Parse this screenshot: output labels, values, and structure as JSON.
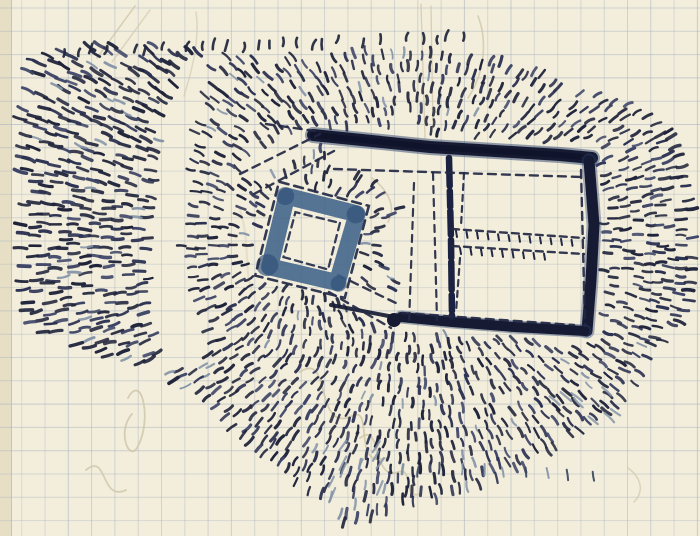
{
  "artwork": {
    "kind": "hand-drawn earthwork plan, ink and blue wash on graph paper",
    "paper": {
      "background": "#f3eedb",
      "left_edge_band": "#e7dfc5",
      "left_edge_line": "#cdc3a4",
      "left_edge_width": 11
    },
    "grid": {
      "color": "#a9b3c0",
      "spacing": 23.3,
      "offset_x": 21.7,
      "offset_y": 8.0,
      "base_opacity": 0.34,
      "opacity_jitter": 0.26
    },
    "inks": {
      "dark": "#20243b",
      "mid": "#2c3252",
      "light": "#3d4466",
      "rampart": "#161b33",
      "rampart_core": "#10142a",
      "rampart_wash": "#2e4470",
      "wash_blue": "#44658b",
      "wash_blue_dark": "#2f4f76",
      "gray_blue": "#8494a8",
      "pencil": "#cfc7ab"
    },
    "hachure_field": {
      "seed": 7,
      "center_main": [
        415,
        245
      ],
      "center_square": [
        312,
        240
      ],
      "square_influence": [
        95,
        135
      ],
      "ring_step": 10.6,
      "arc_step": 10.2,
      "skip_probability": 0.13,
      "radius_range": [
        40,
        452
      ],
      "include_polygon": [
        [
          26,
          62
        ],
        [
          78,
          46
        ],
        [
          148,
          42
        ],
        [
          210,
          48
        ],
        [
          258,
          60
        ],
        [
          330,
          52
        ],
        [
          420,
          46
        ],
        [
          505,
          62
        ],
        [
          575,
          82
        ],
        [
          625,
          102
        ],
        [
          668,
          128
        ],
        [
          694,
          168
        ],
        [
          698,
          240
        ],
        [
          694,
          302
        ],
        [
          662,
          350
        ],
        [
          620,
          404
        ],
        [
          566,
          450
        ],
        [
          514,
          472
        ],
        [
          446,
          496
        ],
        [
          382,
          514
        ],
        [
          344,
          524
        ],
        [
          160,
          370
        ],
        [
          84,
          350
        ],
        [
          30,
          334
        ],
        [
          14,
          262
        ],
        [
          15,
          150
        ]
      ],
      "exclusions": {
        "valley": [
          [
            186,
            52
          ],
          [
            214,
            52
          ],
          [
            196,
            120
          ],
          [
            180,
            250
          ],
          [
            208,
            332
          ],
          [
            199,
            370
          ],
          [
            160,
            370
          ],
          [
            146,
            255
          ],
          [
            162,
            120
          ]
        ],
        "large_enclosure": [
          [
            312,
            124
          ],
          [
            600,
            145
          ],
          [
            603,
            345
          ],
          [
            391,
            329
          ],
          [
            411,
            199
          ],
          [
            331,
            163
          ]
        ],
        "small_enclosure": [
          [
            274,
            177
          ],
          [
            375,
            202
          ],
          [
            350,
            303
          ],
          [
            249,
            278
          ]
        ],
        "upper_causeway": [
          [
            235,
            161
          ],
          [
            313,
            125
          ],
          [
            331,
            141
          ],
          [
            251,
            183
          ]
        ],
        "lower_causeway": [
          [
            333,
            271
          ],
          [
            401,
            303
          ],
          [
            393,
            331
          ],
          [
            323,
            293
          ]
        ]
      }
    },
    "large_enclosure": {
      "top_bar": [
        [
          313,
          135
        ],
        [
          430,
          147
        ],
        [
          560,
          155
        ],
        [
          592,
          158
        ]
      ],
      "right_bar": [
        [
          589,
          161
        ],
        [
          594,
          225
        ],
        [
          591,
          280
        ],
        [
          587,
          331
        ]
      ],
      "bottom_bar": [
        [
          585,
          331
        ],
        [
          515,
          327
        ],
        [
          452,
          322
        ],
        [
          401,
          317
        ]
      ],
      "corner_blob": [
        394,
        320,
        7
      ],
      "tail": [
        [
          399,
          318
        ],
        [
          331,
          305
        ]
      ],
      "inner_wall": [
        [
          449,
          158
        ],
        [
          451,
          240
        ],
        [
          452,
          317
        ]
      ],
      "dashed_lines": [
        {
          "pts": [
            334,
            169,
            582,
            177
          ],
          "dash": "8 6",
          "w": 2.4
        },
        {
          "pts": [
            581,
            170,
            585,
            326
          ],
          "dash": "8 6",
          "w": 2.4
        },
        {
          "pts": [
            402,
            313,
            574,
            325
          ],
          "dash": "8 6",
          "w": 2.4
        },
        {
          "pts": [
            414,
            183,
            409,
            324
          ],
          "dash": "7 6",
          "w": 2.2
        },
        {
          "pts": [
            433,
            173,
            437,
            320
          ],
          "dash": "7 6",
          "w": 2.2
        },
        {
          "pts": [
            452,
            229,
            584,
            238
          ],
          "dash": "7 5",
          "w": 2.4
        },
        {
          "pts": [
            452,
            246,
            584,
            254
          ],
          "dash": "7 5",
          "w": 2.4
        },
        {
          "pts": [
            464,
            173,
            461,
            226
          ],
          "dash": "6 5",
          "w": 2.2
        },
        {
          "pts": [
            460,
            258,
            456,
            312
          ],
          "dash": "6 5",
          "w": 2.2
        },
        {
          "pts": [
            240,
            174,
            320,
            134
          ],
          "dash": "8 6",
          "w": 2.4
        },
        {
          "pts": [
            254,
            194,
            334,
            151
          ],
          "dash": "8 6",
          "w": 2.4
        },
        {
          "pts": [
            338,
            275,
            400,
            305
          ],
          "dash": "8 6",
          "w": 2.4
        },
        {
          "pts": [
            329,
            292,
            391,
            328
          ],
          "dash": "8 6",
          "w": 2.4
        },
        {
          "pts": [
            266,
            124,
            315,
            131
          ],
          "dash": "8 6",
          "w": 2.4
        }
      ],
      "ladder": {
        "x0": 456,
        "x1": 574,
        "step": 10.5,
        "rowA": [
          229,
          238
        ],
        "rowB": [
          246,
          254
        ],
        "rowB_max_x": 545,
        "tick_len": 6
      }
    },
    "small_enclosure": {
      "center": [
        312,
        240
      ],
      "rotation_deg": 14,
      "ring_half": 36,
      "ring_width": 17,
      "outer_dash_half": 47,
      "inner_dash_half": 24,
      "corner_blob_radii": [
        9,
        8,
        11,
        9
      ]
    },
    "tick_rows": [
      {
        "from": [
          64,
          52
        ],
        "to": [
          462,
          37
        ],
        "n": 30,
        "angle": 100,
        "len": [
          7,
          11
        ],
        "w": 2.6,
        "colors": [
          "#20243b"
        ],
        "skip": 0.15,
        "curve": 2.5
      },
      {
        "from": [
          418,
          470
        ],
        "to": [
          592,
          474
        ],
        "n": 9,
        "angle": 88,
        "len": [
          9,
          12
        ],
        "w": 2.0,
        "colors": [
          "#3a4660",
          "#8494a8"
        ],
        "skip": 0.1,
        "curve": 1.0
      }
    ],
    "gray_clusters": [
      {
        "rect": [
          330,
          443,
          55,
          55
        ],
        "n": 10,
        "angle": -62,
        "len": 13,
        "w": 2.2,
        "color": "#8494a8"
      },
      {
        "rect": [
          550,
          380,
          72,
          48
        ],
        "n": 8,
        "angle": 40,
        "len": 12,
        "w": 2.2,
        "color": "#8494a8"
      }
    ],
    "pencil_strokes": [
      {
        "d": "M421,4 L425,138",
        "w": 1.3,
        "o": 0.8
      },
      {
        "d": "M431,6 L433,128",
        "w": 1.3,
        "o": 0.8
      },
      {
        "d": "M97,58 L135,6",
        "w": 1.6,
        "o": 0.8
      },
      {
        "d": "M112,62 L150,10",
        "w": 1.4,
        "o": 0.7
      },
      {
        "d": "M478,16 C488,42 484,74 468,98",
        "w": 1.6,
        "o": 0.8
      },
      {
        "d": "M372,178 C390,192 396,208 388,222",
        "w": 1.6,
        "o": 0.8
      },
      {
        "d": "M196,12 C200,40 192,70 184,96",
        "w": 1.5,
        "o": 0.6
      },
      {
        "d": "M128,398 C142,372 152,420 138,446 C130,464 116,432 132,414",
        "w": 1.8,
        "o": 0.85
      },
      {
        "d": "M300,372 C332,350 314,434 352,416 C374,404 352,470 386,458",
        "w": 1.8,
        "o": 0.85
      },
      {
        "d": "M360,438 C382,420 372,482 398,472 C414,466 402,500 420,494",
        "w": 1.8,
        "o": 0.8
      },
      {
        "d": "M86,470 C108,452 100,502 126,490",
        "w": 1.8,
        "o": 0.8
      },
      {
        "d": "M628,468 C642,478 644,492 634,502",
        "w": 1.5,
        "o": 0.7
      },
      {
        "d": "M240,210 C250,240 244,270 252,292",
        "w": 2.2,
        "o": 0.35
      }
    ]
  }
}
